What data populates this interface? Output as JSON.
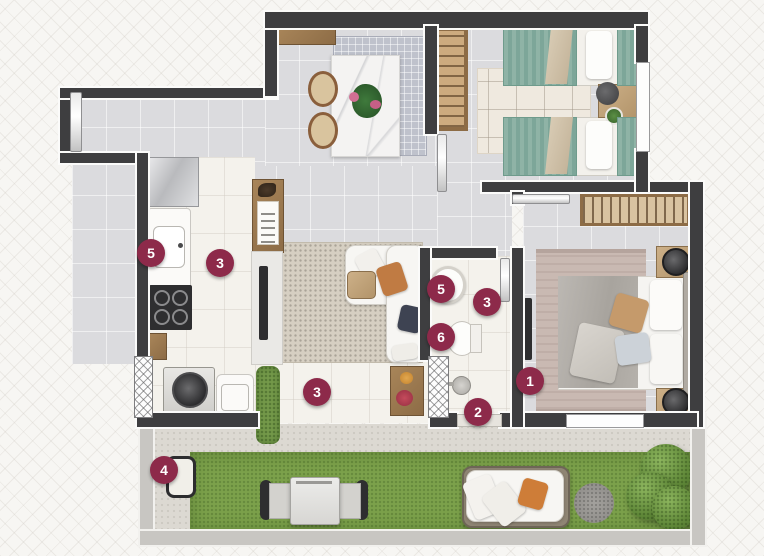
{
  "plan_markers": {
    "items": [
      {
        "name": "suite-bedroom",
        "label": "1",
        "x": 530,
        "y": 381
      },
      {
        "name": "terrace-access",
        "label": "2",
        "x": 478,
        "y": 412
      },
      {
        "name": "kitchen-floor",
        "label": "3",
        "x": 220,
        "y": 263
      },
      {
        "name": "bathroom-floor",
        "label": "3",
        "x": 487,
        "y": 302
      },
      {
        "name": "balcony-floor",
        "label": "3",
        "x": 317,
        "y": 392
      },
      {
        "name": "terrace-fixture",
        "label": "4",
        "x": 164,
        "y": 470
      },
      {
        "name": "kitchen-sink",
        "label": "5",
        "x": 151,
        "y": 253
      },
      {
        "name": "bathroom-sink",
        "label": "5",
        "x": 441,
        "y": 289
      },
      {
        "name": "toilet",
        "label": "6",
        "x": 441,
        "y": 337
      }
    ]
  },
  "colors": {
    "badge_bg": "#8d2a4a",
    "badge_text": "#ffffff",
    "wall": "#3e3e40",
    "grass": "#7ca14b",
    "floor_gray": "#dbdbde",
    "floor_white": "#f4f2ec",
    "terrace_wall": "#c8c6c2",
    "background": "#f7f6f3"
  }
}
